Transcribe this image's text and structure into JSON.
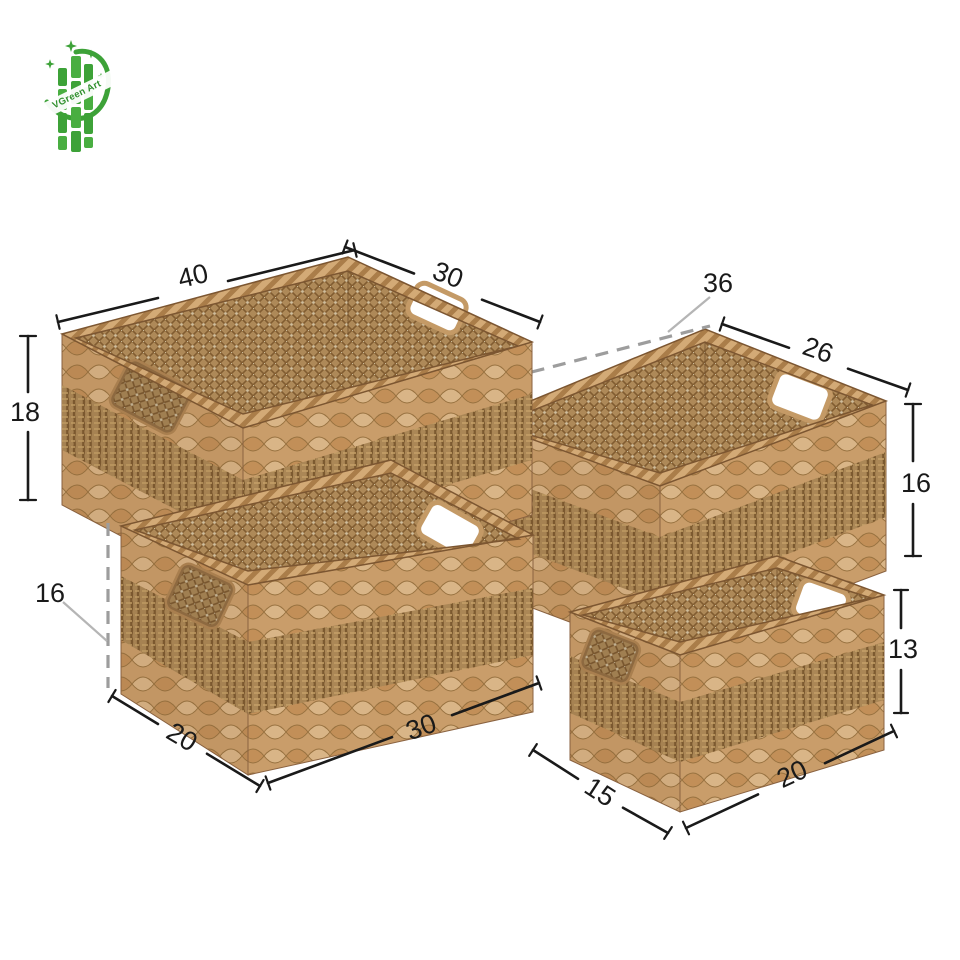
{
  "page": {
    "background": "#ffffff"
  },
  "logo": {
    "brand": "VGreen Art",
    "color": "#3da238"
  },
  "diagram": {
    "baskets": [
      {
        "name": "large",
        "label_length": "40",
        "label_width": "30",
        "label_height": "18"
      },
      {
        "name": "medium",
        "label_length": "36",
        "label_width": "26",
        "label_height": "16"
      },
      {
        "name": "small",
        "label_length": "30",
        "label_width": "20",
        "label_height": "16"
      },
      {
        "name": "mini",
        "label_length": "20",
        "label_width": "15",
        "label_height": "13"
      }
    ],
    "colors": {
      "dimension_line": "#1a1a1a",
      "hidden_dimension_line": "#9d9d9d",
      "basket_tan": "#c99d6a",
      "seagrass_band": "#ab8756"
    }
  }
}
